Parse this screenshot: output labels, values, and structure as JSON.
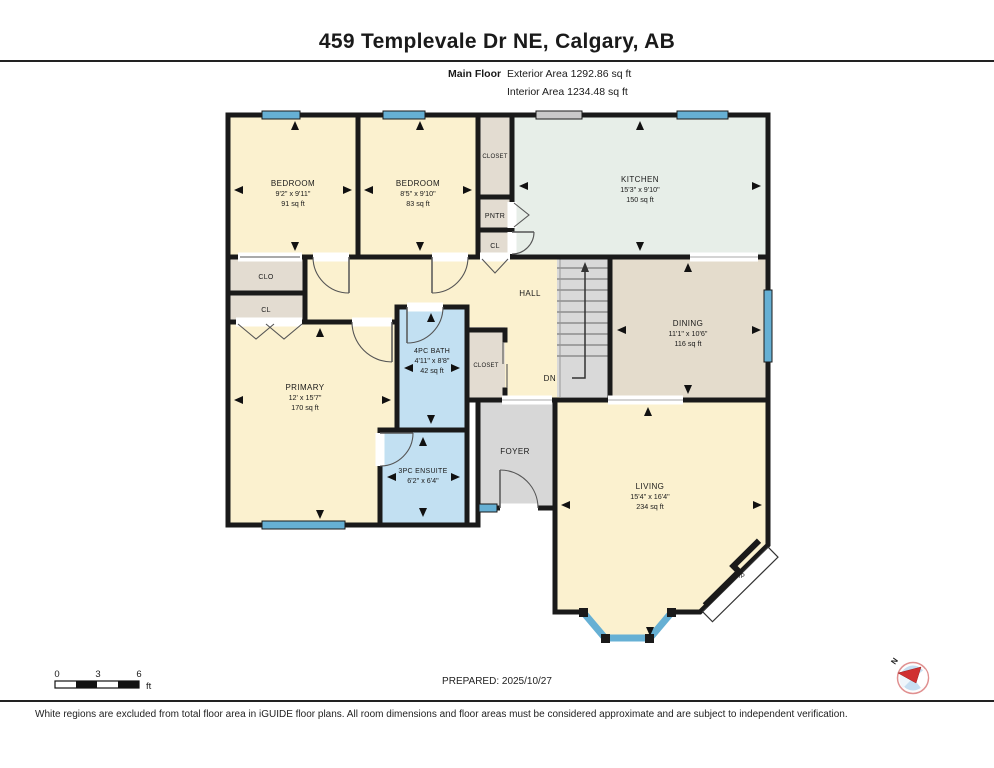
{
  "header": {
    "title": "459 Templevale Dr NE, Calgary, AB",
    "floor_label": "Main Floor",
    "exterior_area": "Exterior Area 1292.86 sq ft",
    "interior_area": "Interior Area 1234.48 sq ft"
  },
  "rooms": {
    "bedroom1": {
      "name": "BEDROOM",
      "dims": "9'2\" x 9'11\"",
      "area": "91 sq ft"
    },
    "bedroom2": {
      "name": "BEDROOM",
      "dims": "8'5\" x 9'10\"",
      "area": "83 sq ft"
    },
    "kitchen": {
      "name": "KITCHEN",
      "dims": "15'3\" x 9'10\"",
      "area": "150 sq ft"
    },
    "dining": {
      "name": "DINING",
      "dims": "11'1\" x 10'6\"",
      "area": "116 sq ft"
    },
    "primary": {
      "name": "PRIMARY",
      "dims": "12' x 15'7\"",
      "area": "170 sq ft"
    },
    "bath4pc": {
      "name": "4PC BATH",
      "dims": "4'11\" x 8'8\"",
      "area": "42 sq ft"
    },
    "ensuite": {
      "name": "3PC ENSUITE",
      "dims": "6'2\" x 6'4\""
    },
    "living": {
      "name": "LIVING",
      "dims": "15'4\" x 16'4\"",
      "area": "234 sq ft"
    },
    "hall": "HALL",
    "foyer": "FOYER",
    "closet_top": "CLOSET",
    "pantry": "PNTR",
    "cl_top": "CL",
    "clo_left": "CLO",
    "cl_left": "CL",
    "closet_mid": "CLOSET",
    "down": "DN",
    "fireplace": "F/P"
  },
  "footer": {
    "scale": {
      "tick0": "0",
      "tick3": "3",
      "tick6": "6",
      "unit": "ft"
    },
    "prepared": "PREPARED: 2025/10/27",
    "compass_north": "N",
    "disclaimer": "White regions are excluded from total floor area in iGUIDE floor plans. All room dimensions and floor areas must be considered approximate and are subject to independent verification."
  },
  "colors": {
    "room_cream": "#fbf1cf",
    "kitchen_green": "#e7eee8",
    "dining_tan": "#e4dccc",
    "bath_blue": "#c2e0f2",
    "closet_beige": "#e3dcd1",
    "floor_grey": "#d7d7d7",
    "stairs_grey": "#d9d9d9",
    "window_blue": "#66b0d4",
    "slider_grey": "#c9c9c9",
    "wall_black": "#1a1a1a"
  }
}
